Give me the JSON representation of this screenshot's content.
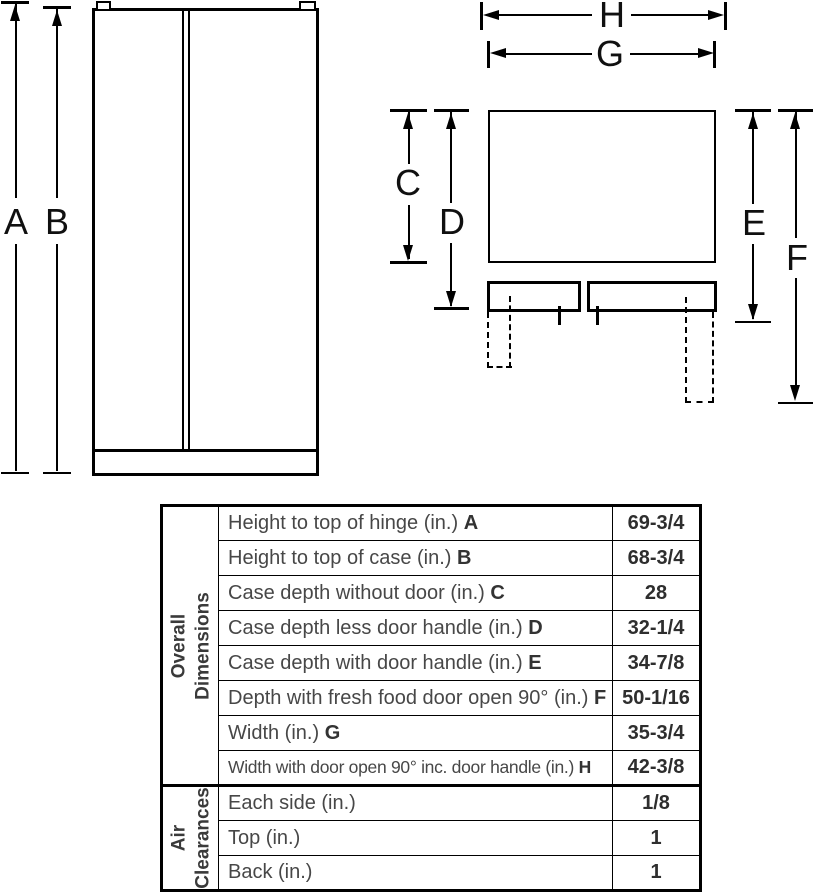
{
  "diagram": {
    "line_color": "#000000",
    "front_labels": {
      "a": "A",
      "b": "B"
    },
    "top_labels": {
      "c": "C",
      "d": "D",
      "e": "E",
      "f": "F",
      "g": "G",
      "h": "H"
    }
  },
  "table": {
    "sections": [
      {
        "header": "Overall Dimensions",
        "rows": [
          {
            "label": "Height to top of hinge (in.)",
            "letter": "A",
            "value": "69-3/4"
          },
          {
            "label": "Height to top of case (in.)",
            "letter": "B",
            "value": "68-3/4"
          },
          {
            "label": "Case depth without door (in.)",
            "letter": "C",
            "value": "28"
          },
          {
            "label": "Case depth less door handle (in.)",
            "letter": "D",
            "value": "32-1/4"
          },
          {
            "label": "Case depth with door handle (in.)",
            "letter": "E",
            "value": "34-7/8"
          },
          {
            "label": "Depth with fresh food door open 90° (in.)",
            "letter": "F",
            "value": "50-1/16"
          },
          {
            "label": "Width (in.)",
            "letter": "G",
            "value": "35-3/4"
          },
          {
            "label": "Width with door open 90° inc. door handle (in.)",
            "letter": "H",
            "value": "42-3/8"
          }
        ]
      },
      {
        "header": "Air Clearances",
        "rows": [
          {
            "label": "Each side (in.)",
            "value": "1/8"
          },
          {
            "label": "Top (in.)",
            "value": "1"
          },
          {
            "label": "Back (in.)",
            "value": "1"
          }
        ]
      }
    ]
  }
}
